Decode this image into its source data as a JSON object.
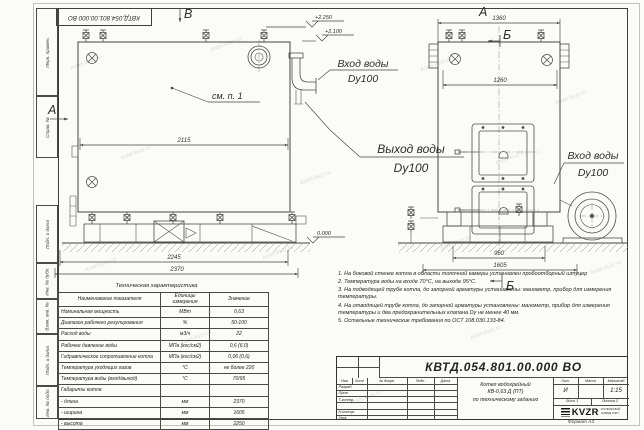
{
  "watermark": "kotel-kvzr.ru",
  "stamp_top": "КВТД.054.801.00.000 ВО",
  "frame": {
    "left_labels": [
      "Перв. примен.",
      "Справ. №",
      "Подп. и дата",
      "Инв. № дубл.",
      "Взам. инв. №",
      "Подп. и дата",
      "Инв. № подл."
    ]
  },
  "drawing": {
    "front": {
      "marker_top": "В",
      "marker_left": "А",
      "callout": "см. п. 1",
      "dim_width": "2115",
      "dim_base": "2245",
      "dim_overall": "2370",
      "level_top": "+2.250",
      "level_mid": "+2.100",
      "level_ground": "0.000"
    },
    "side": {
      "view_title": "А",
      "section_top": "Б",
      "section_bottom": "Б",
      "dim_top": "1360",
      "dim_inner": "1260",
      "dim_base": "960",
      "dim_overall": "1605"
    },
    "pipes": {
      "inlet_top_1": "Вход воды",
      "inlet_top_2": "Dy100",
      "outlet_1": "Выход воды",
      "outlet_2": "Dy100",
      "inlet_right_1": "Вход воды",
      "inlet_right_2": "Dy100"
    }
  },
  "tech_table": {
    "title": "Техническая характеристика",
    "headers": [
      "Наименование показателя",
      "Единицы измерения",
      "Значение"
    ],
    "rows": [
      {
        "name": "Номинальная мощность",
        "unit": "МВт",
        "value": "0,63"
      },
      {
        "name": "Диапазон рабочего регулирования",
        "unit": "%",
        "value": "50-100"
      },
      {
        "name": "Расход воды",
        "unit": "м3/ч",
        "value": "22"
      },
      {
        "name": "Рабочее давление воды",
        "unit": "МПа (кгс/см2)",
        "value": "0,6 (6,0)"
      },
      {
        "name": "Гидравлическое сопротивление котла",
        "unit": "МПа (кгс/см2)",
        "value": "0,06 (0,6)"
      },
      {
        "name": "Температура уходящих газов",
        "unit": "°С",
        "value": "не более 220"
      },
      {
        "name": "Температура воды (вход/выход)",
        "unit": "°С",
        "value": "70/95"
      },
      {
        "name": "Габариты котла",
        "unit": "",
        "value": ""
      },
      {
        "name": "- длина",
        "unit": "мм",
        "value": "2370"
      },
      {
        "name": "- ширина",
        "unit": "мм",
        "value": "1605"
      },
      {
        "name": "- высота",
        "unit": "мм",
        "value": "2250"
      }
    ]
  },
  "notes": [
    "1. На боковой стенке котла в области топочной камеры установлен пробоотборный штуцер",
    "2. Температура воды на входе 70°С, на выходе 95°С.",
    "3. На подводящей трубе котла, до запорной арматуры установлены: манометр, прибор для измерения температуры.",
    "4. На отводящей трубе котла, до запорной арматуры установлены: манометр, прибор для измерения температуры и два предохранительных клапана Dу не менее 40 мм.",
    "5. Остальные технические требования по ОСТ 108.030.133-84."
  ],
  "title_block": {
    "doc_number": "КВТД.054.801.00.000 ВО",
    "rev_header": [
      "Изм",
      "Лист",
      "№ докум.",
      "Подп.",
      "Дата"
    ],
    "sign_rows": [
      "Разраб.",
      "Пров.",
      "Т.контр.",
      "",
      "Н.контр.",
      "Утв."
    ],
    "name_line1": "Котел водогрейный",
    "name_line2": "КВ-0,63 Д (ПТ)",
    "name_line3": "по техническому заданию",
    "lit_header": [
      "Лит.",
      "Масса",
      "Масштаб"
    ],
    "lit_value": "И",
    "scale": "1:15",
    "sheet": "Лист 1",
    "sheets": "Листов 2",
    "logo_text": "KVZR",
    "logo_caption1": "КОТЕЛЬНЫЙ",
    "logo_caption2": "ЗАВОД РЭП",
    "format": "Формат А3"
  }
}
